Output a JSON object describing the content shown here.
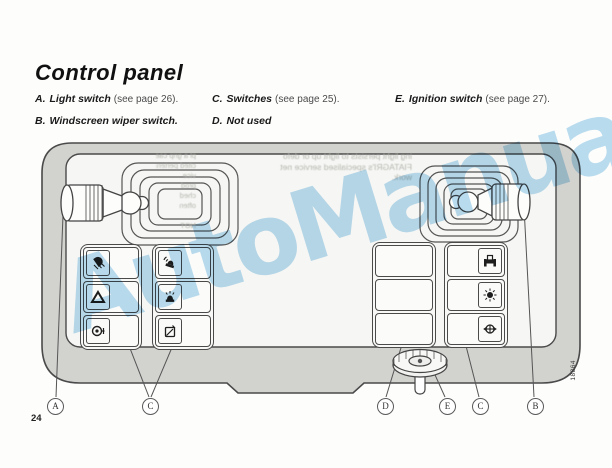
{
  "page": {
    "title": "Control panel",
    "page_number": "24",
    "figure_code": "18864"
  },
  "legend": {
    "row1": [
      {
        "id": "A.",
        "label": "Light switch",
        "note": "(see page 26)."
      },
      {
        "id": "C.",
        "label": "Switches",
        "note": "(see page 25)."
      },
      {
        "id": "E.",
        "label": "Ignition switch",
        "note": "(see page 27)."
      }
    ],
    "row2": [
      {
        "id": "B.",
        "label": "Windscreen wiper switch.",
        "note": ""
      },
      {
        "id": "D.",
        "label": "Not used",
        "note": ""
      }
    ]
  },
  "watermark": {
    "text": "AutoManual",
    "color": "#b3daf0"
  },
  "diagram": {
    "callouts": [
      "A",
      "C",
      "D",
      "E",
      "C",
      "B"
    ],
    "icons": {
      "left_group_1": [
        "front-fog-light-icon",
        "hazard-warning-icon",
        "work-light-icon"
      ],
      "left_group_2": [
        "rotating-beacon-icon",
        "beacon-icon",
        "screen-washer-icon"
      ],
      "middle_group": [
        "blank",
        "blank",
        "blank"
      ],
      "right_group": [
        "tractor-icon",
        "warning-light-icon",
        "differential-lock-icon"
      ]
    },
    "ghost_text": {
      "left_fragments": [
        "pl a grip caecr will",
        "cited pertenne of FIA",
        "vice",
        "prod",
        "ched",
        "often",
        "",
        "NOT"
      ],
      "right_lines": [
        "ing light persists to light up or defo",
        "FIATAGRI's specialised service net",
        "work."
      ]
    }
  }
}
